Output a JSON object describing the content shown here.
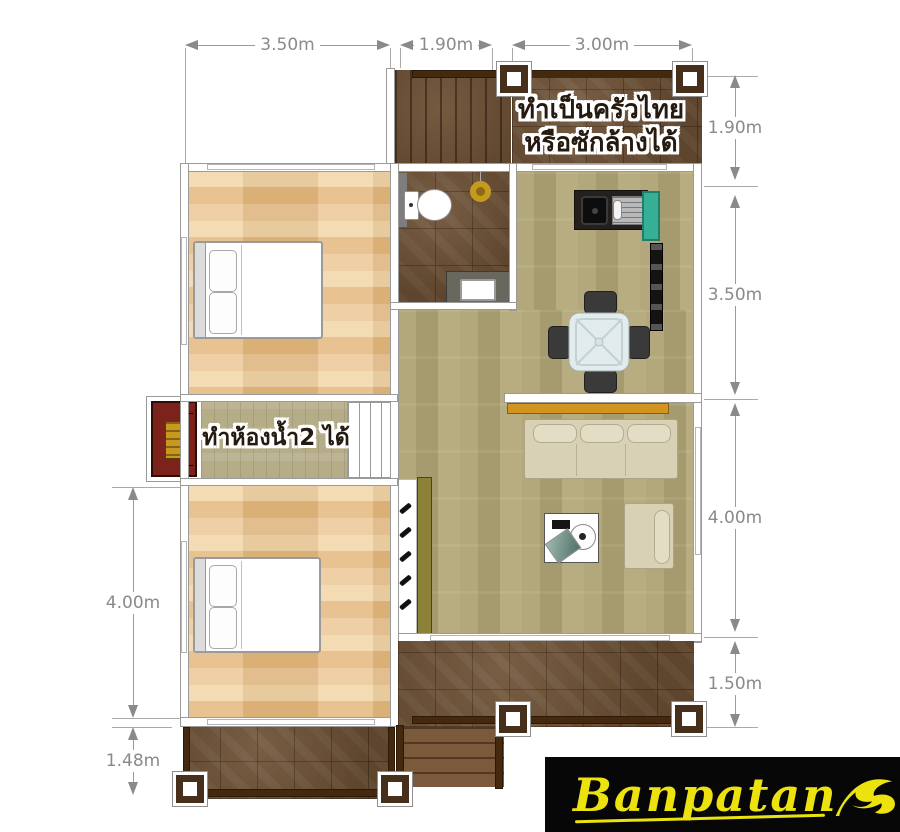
{
  "annotations": {
    "kitchen_note_line1": "ทำเป็นครัวไทย",
    "kitchen_note_line2": "หรือซักล้างได้",
    "bathroom_note": "ทำห้องน้ำ2 ได้"
  },
  "dimensions": {
    "top": [
      {
        "label": "3.50m"
      },
      {
        "label": "1.90m"
      },
      {
        "label": "3.00m"
      }
    ],
    "right": [
      {
        "label": "1.90m"
      },
      {
        "label": "3.50m"
      },
      {
        "label": "4.00m"
      },
      {
        "label": "1.50m"
      }
    ],
    "left": [
      {
        "label": "4.00m"
      },
      {
        "label": "1.48m"
      }
    ]
  },
  "logo": {
    "brand": "Banpatan"
  },
  "colors": {
    "deck_tile_brown": "#6d5034",
    "bedroom_wood": "#e7c08a",
    "living_wood": "#aba174",
    "hall_wood": "#b5ac88",
    "kitchen_cabinet_teal": "#35b096",
    "shelf_gold": "#d3941f",
    "sofa_cream": "#d8d1b6",
    "shrine_maroon": "#7b221a",
    "drain_gold": "#c59a1e",
    "logo_yellow": "#ece20e",
    "dimension_gray": "#8a8a8a"
  },
  "furniture_icons": [
    "bed",
    "pillow",
    "toilet",
    "floor-drain",
    "sink-vanity",
    "kitchen-counter",
    "kitchen-sink",
    "dish-rack",
    "teal-cabinet",
    "dining-table",
    "dining-chair",
    "console-shelf",
    "sofa",
    "armchair",
    "coffee-table",
    "shrine-cabinet",
    "stairs",
    "column-post"
  ]
}
